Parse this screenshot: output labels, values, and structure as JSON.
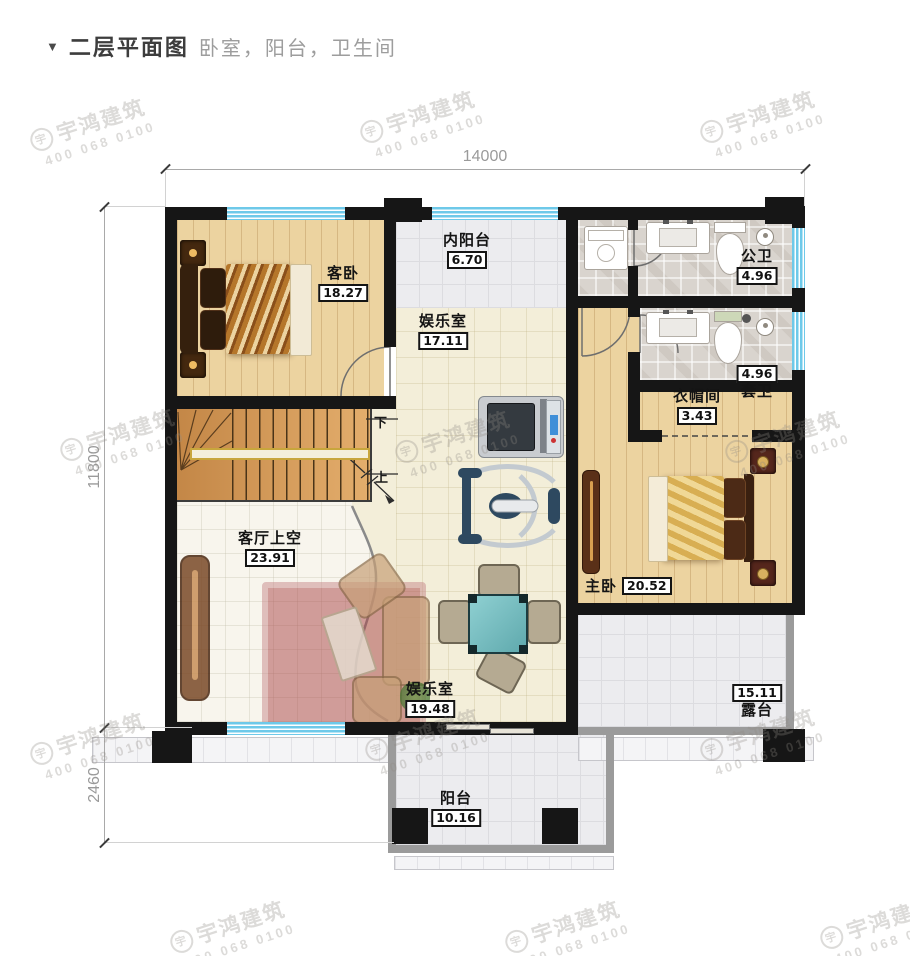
{
  "header": {
    "marker": "▼",
    "title": "二层平面图",
    "subtitle": "卧室，阳台，卫生间"
  },
  "dimensions": {
    "top": "14000",
    "left_upper": "11800",
    "left_lower": "2460"
  },
  "rooms": {
    "guest_bedroom": {
      "name": "客卧",
      "area": "18.27"
    },
    "inner_balcony": {
      "name": "内阳台",
      "area": "6.70"
    },
    "public_bath": {
      "name": "公卫",
      "area": "4.96"
    },
    "game_room_upper": {
      "name": "娱乐室",
      "area": "17.11"
    },
    "ensuite_bath": {
      "name": "套卫",
      "area": "4.96"
    },
    "cloakroom": {
      "name": "衣帽间",
      "area": "3.43"
    },
    "living_void": {
      "name": "客厅上空",
      "area": "23.91"
    },
    "master_bedroom": {
      "name": "主卧",
      "area": "20.52"
    },
    "game_room_lower": {
      "name": "娱乐室",
      "area": "19.48"
    },
    "terrace": {
      "name": "露台",
      "area": "15.11"
    },
    "balcony": {
      "name": "阳台",
      "area": "10.16"
    }
  },
  "stairs": {
    "down": "下",
    "up": "上"
  },
  "watermark": {
    "logo": "宇",
    "line1": "宇鸿建筑",
    "line2": "400 068 0100"
  },
  "colors": {
    "wall": "#161616",
    "window": "#6ec9e9",
    "wood": "#ecd3a0",
    "stair_wood": "#dda05b",
    "tile_gray": "#ececef",
    "tile_cream": "#f3eed9",
    "bath_tile": "#d9d4ce",
    "table_teal": "#7cc6c9",
    "rug_red": "#a94548"
  }
}
